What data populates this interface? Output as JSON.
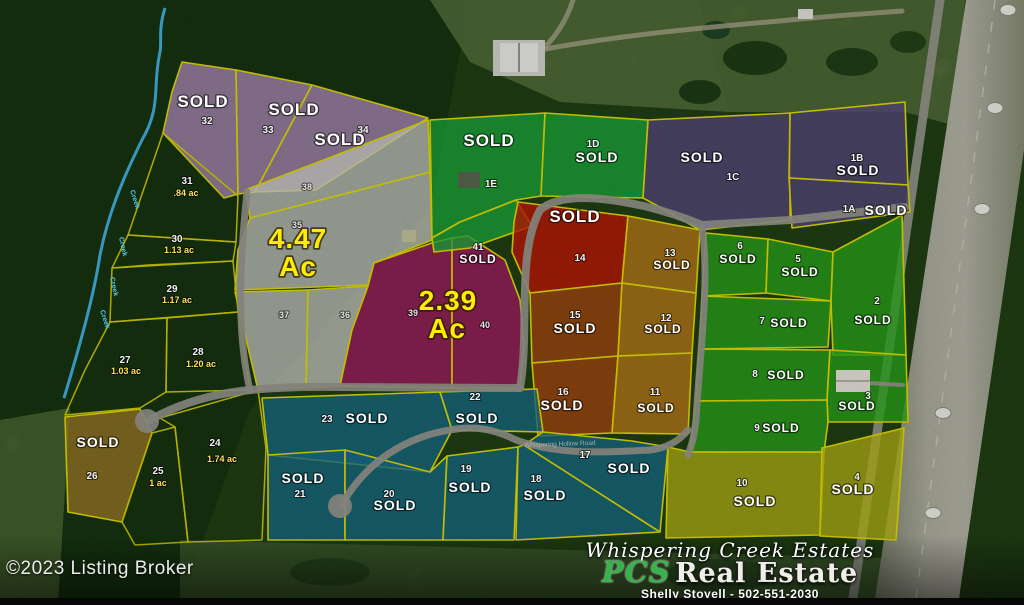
{
  "meta": {
    "copyright": "©2023 Listing Broker"
  },
  "branding": {
    "estate_name": "Whispering Creek Estates",
    "brokerage_script": "PCS",
    "brokerage_word": "Real Estate",
    "agent_line": "Shelly Stoyell - 502-551-2030"
  },
  "labels": {
    "sold": "SOLD",
    "creek": "Creek",
    "road": "Whispering Hollow Road",
    "gray_tract_acreage": "4.47",
    "magenta_tract_acreage": "2.39",
    "acre_suffix": "Ac"
  },
  "colors": {
    "boundary_yellow": "#e6e000",
    "purple_pink": "#bb93c6",
    "gray_tract": "#d6d6ce",
    "magenta": "#b01a6a",
    "green": "#1db33e",
    "dark_purple": "#5b4a85",
    "red": "#d11605",
    "burnt_orange": "#b3490f",
    "orange": "#c9821a",
    "bright_green": "#2cb01c",
    "teal_blue": "#17718f",
    "olive_yellow": "#bcbc16",
    "tan_gold": "#a8812a",
    "creek_blue": "#45bdef",
    "acreage_yellow": "#ffec00",
    "sold_text": "#ffffff"
  },
  "lots": {
    "32": {
      "num": "32",
      "status": "SOLD"
    },
    "33": {
      "num": "33",
      "status": "SOLD"
    },
    "34": {
      "num": "34",
      "status": "SOLD"
    },
    "38": {
      "num": "38"
    },
    "35": {
      "num": "35"
    },
    "37": {
      "num": "37"
    },
    "36": {
      "num": "36"
    },
    "39": {
      "num": "39"
    },
    "40": {
      "num": "40"
    },
    "41": {
      "num": "41",
      "status": "SOLD"
    },
    "1E": {
      "num": "1E",
      "status": "SOLD"
    },
    "1D": {
      "num": "1D",
      "status": "SOLD"
    },
    "1C": {
      "num": "1C",
      "status": "SOLD"
    },
    "1B": {
      "num": "1B",
      "status": "SOLD"
    },
    "1A": {
      "num": "1A",
      "status": "SOLD"
    },
    "14": {
      "num": "14",
      "status": "SOLD"
    },
    "15": {
      "num": "15",
      "status": "SOLD"
    },
    "16": {
      "num": "16",
      "status": "SOLD"
    },
    "13": {
      "num": "13",
      "status": "SOLD"
    },
    "12": {
      "num": "12",
      "status": "SOLD"
    },
    "11": {
      "num": "11",
      "status": "SOLD"
    },
    "6": {
      "num": "6",
      "status": "SOLD"
    },
    "5": {
      "num": "5",
      "status": "SOLD"
    },
    "2": {
      "num": "2",
      "status": "SOLD"
    },
    "7": {
      "num": "7",
      "status": "SOLD"
    },
    "8": {
      "num": "8",
      "status": "SOLD"
    },
    "3": {
      "num": "3",
      "status": "SOLD"
    },
    "9": {
      "num": "9",
      "status": "SOLD"
    },
    "23": {
      "num": "23",
      "status": "SOLD"
    },
    "22": {
      "num": "22",
      "status": "SOLD"
    },
    "21": {
      "num": "21",
      "status": "SOLD"
    },
    "20": {
      "num": "20",
      "status": "SOLD"
    },
    "19": {
      "num": "19",
      "status": "SOLD"
    },
    "18": {
      "num": "18",
      "status": "SOLD"
    },
    "17": {
      "num": "17",
      "status": "SOLD"
    },
    "10": {
      "num": "10",
      "status": "SOLD"
    },
    "4": {
      "num": "4",
      "status": "SOLD"
    },
    "26": {
      "num": "26",
      "status": "SOLD"
    },
    "31": {
      "num": "31",
      "acreage": ".84 ac"
    },
    "30": {
      "num": "30",
      "acreage": "1.13 ac"
    },
    "29": {
      "num": "29",
      "acreage": "1.17 ac"
    },
    "27": {
      "num": "27",
      "acreage": "1.03 ac"
    },
    "28": {
      "num": "28",
      "acreage": "1.20 ac"
    },
    "24": {
      "num": "24",
      "acreage": "1.74 ac"
    },
    "25": {
      "num": "25",
      "acreage": "1 ac"
    }
  }
}
